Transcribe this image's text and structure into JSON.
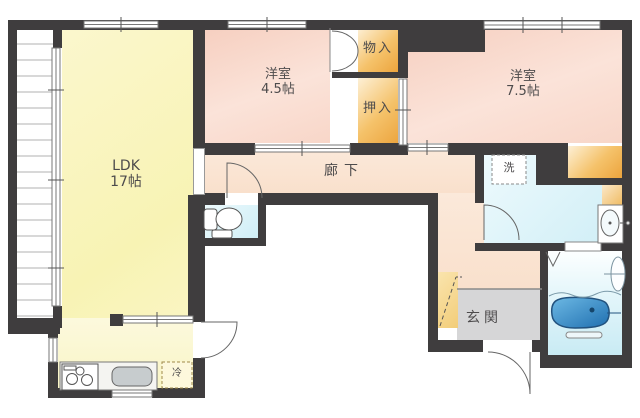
{
  "plan": {
    "title": "apartment-floor-plan",
    "rooms": {
      "ldk": {
        "name": "LDK",
        "size": "17帖"
      },
      "bedroom_45": {
        "name": "洋室",
        "size": "4.5帖"
      },
      "bedroom_75": {
        "name": "洋室",
        "size": "7.5帖"
      },
      "hallway": {
        "name": "廊下"
      },
      "entrance": {
        "name": "玄関"
      },
      "storage": {
        "name": "物入"
      },
      "closet": {
        "name": "押入"
      }
    },
    "fixtures": {
      "washer_label": "洗",
      "fridge_label": "冷"
    },
    "colors": {
      "wall": "#3f3d3e",
      "ldk_floor": "#f8f3b4",
      "bedroom_floor": "#f8d6c8",
      "hallway_floor": "#f9e0cc",
      "closet_fill": "#eca43d",
      "water_room": "#cfeef6",
      "bathtub": "#3387c6",
      "genkan_floor": "#d6d6d7",
      "shoe_cabinet": "#f2cd79"
    }
  }
}
